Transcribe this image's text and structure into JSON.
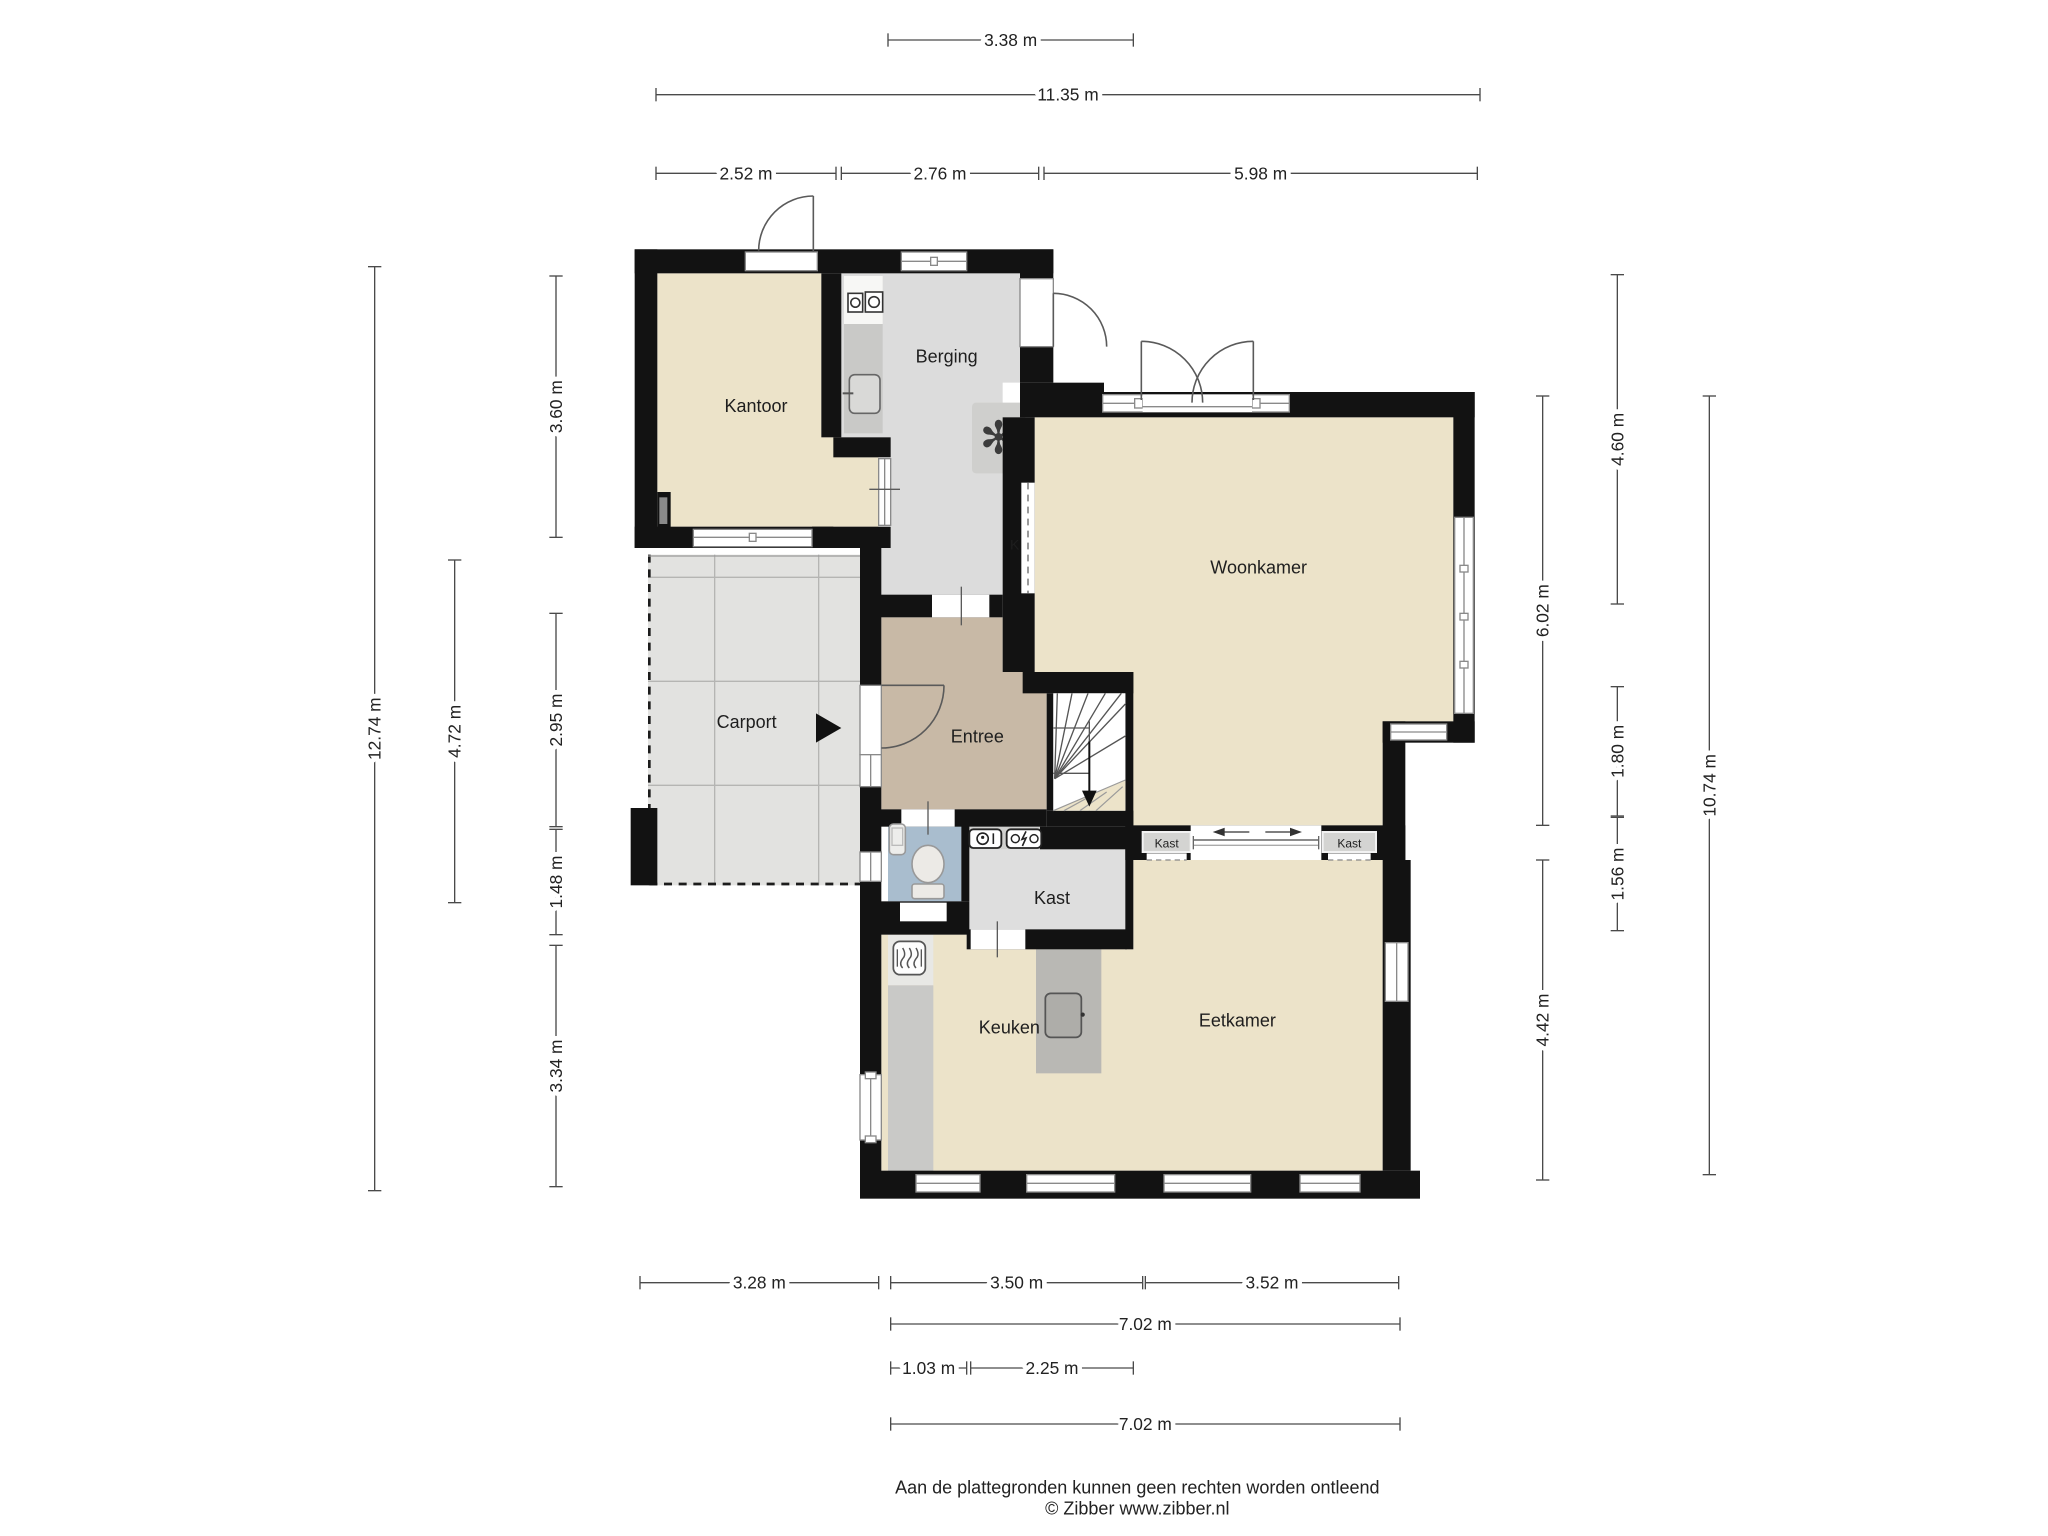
{
  "rooms": {
    "kantoor": "Kantoor",
    "berging": "Berging",
    "woonkamer": "Woonkamer",
    "carport": "Carport",
    "entree": "Entree",
    "kast_room": "Kast",
    "keuken": "Keuken",
    "eetkamer": "Eetkamer",
    "k_closet": "K",
    "kast_niche_left": "Kast",
    "kast_niche_right": "Kast"
  },
  "icons": {
    "fan_glyph": "✻",
    "names": [
      "ventilation-fan-icon",
      "washer-icon",
      "dryer-icon",
      "sink-icon",
      "water-meter-icon",
      "electric-meter-icon",
      "heater-icon",
      "toilet-icon",
      "stove-icon",
      "entrance-arrow-icon",
      "stairs-down-arrow-icon"
    ]
  },
  "dimensions": [
    {
      "label": "3.38 m",
      "o": "h",
      "x1": 666,
      "x2": 850,
      "y": 30
    },
    {
      "label": "11.35 m",
      "o": "h",
      "x1": 492,
      "x2": 1110,
      "y": 71
    },
    {
      "label": "2.52 m",
      "o": "h",
      "x1": 492,
      "x2": 627,
      "y": 130
    },
    {
      "label": "2.76 m",
      "o": "h",
      "x1": 631,
      "x2": 779,
      "y": 130
    },
    {
      "label": "5.98 m",
      "o": "h",
      "x1": 783,
      "x2": 1108,
      "y": 130
    },
    {
      "label": "12.74 m",
      "o": "v",
      "y1": 200,
      "y2": 893,
      "x": 281
    },
    {
      "label": "4.72 m",
      "o": "v",
      "y1": 420,
      "y2": 677,
      "x": 341
    },
    {
      "label": "3.60 m",
      "o": "v",
      "y1": 207,
      "y2": 403,
      "x": 417
    },
    {
      "label": "2.95 m",
      "o": "v",
      "y1": 460,
      "y2": 620,
      "x": 417
    },
    {
      "label": "1.48 m",
      "o": "v",
      "y1": 622,
      "y2": 701,
      "x": 417
    },
    {
      "label": "3.34 m",
      "o": "v",
      "y1": 709,
      "y2": 890,
      "x": 417
    },
    {
      "label": "6.02 m",
      "o": "v",
      "y1": 297,
      "y2": 619,
      "x": 1157
    },
    {
      "label": "4.42 m",
      "o": "v",
      "y1": 645,
      "y2": 885,
      "x": 1157
    },
    {
      "label": "4.60 m",
      "o": "v",
      "y1": 206,
      "y2": 453,
      "x": 1213
    },
    {
      "label": "1.80 m",
      "o": "v",
      "y1": 515,
      "y2": 612,
      "x": 1213
    },
    {
      "label": "1.56 m",
      "o": "v",
      "y1": 613,
      "y2": 698,
      "x": 1213
    },
    {
      "label": "10.74 m",
      "o": "v",
      "y1": 297,
      "y2": 881,
      "x": 1282
    },
    {
      "label": "3.28 m",
      "o": "h",
      "x1": 480,
      "x2": 659,
      "y": 962
    },
    {
      "label": "3.50 m",
      "o": "h",
      "x1": 668,
      "x2": 857,
      "y": 962
    },
    {
      "label": "3.52 m",
      "o": "h",
      "x1": 859,
      "x2": 1049,
      "y": 962
    },
    {
      "label": "7.02 m",
      "o": "h",
      "x1": 668,
      "x2": 1050,
      "y": 993
    },
    {
      "label": "1.03 m",
      "o": "h",
      "x1": 668,
      "x2": 725,
      "y": 1026
    },
    {
      "label": "2.25 m",
      "o": "h",
      "x1": 728,
      "x2": 850,
      "y": 1026
    },
    {
      "label": "7.02 m",
      "o": "h",
      "x1": 668,
      "x2": 1050,
      "y": 1068
    }
  ],
  "footer": {
    "line1": "Aan de plattegronden kunnen geen rechten worden ontleend",
    "line2": "© Zibber www.zibber.nl"
  },
  "colors": {
    "wall": "#121212",
    "floor_beige": "#ece3c9",
    "storage_gray": "#dcdcdc",
    "carport_gray": "#e2e2e0",
    "entree_tan": "#c8b9a6",
    "toilet_blue": "#a9bdce",
    "counter_gray": "#c9c9c7",
    "island_gray": "#b9b8b4",
    "dimension_line": "#4a4a4a"
  }
}
